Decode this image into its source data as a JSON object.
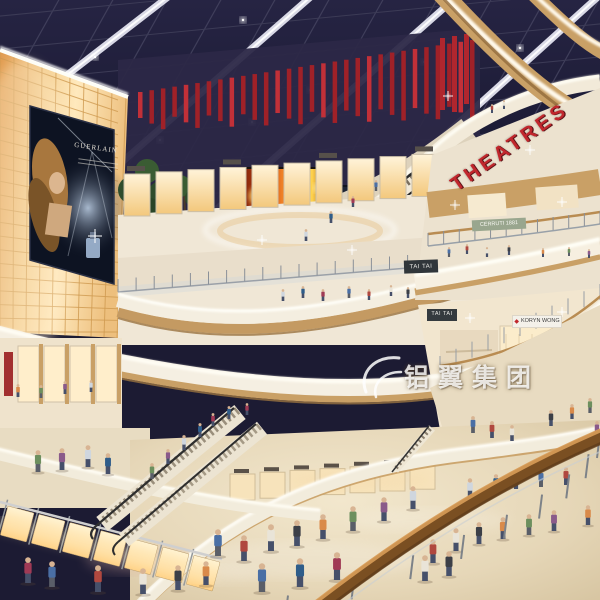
{
  "scene": {
    "label": "shopping-mall-atrium-rendering"
  },
  "signs": {
    "theatres": "THEATRES",
    "billboard_brand": "GUERLAIN",
    "tai_tai_upper": "TAI TAI",
    "tai_tai_lower": "TAI TAI",
    "cerruti": "CERRUTI 1881",
    "boutique": "KORYN WONG"
  },
  "watermark": {
    "text": "铝翼集团"
  },
  "icons": {
    "boutique_logo": "◆"
  },
  "colors": {
    "accent_red": "#c1272d",
    "sky": "#201f38",
    "amber_wall": "#f3cd8f",
    "wood": "#c49a62",
    "cream_fascia": "#f2ead9",
    "floor": "#e6d9bf"
  }
}
